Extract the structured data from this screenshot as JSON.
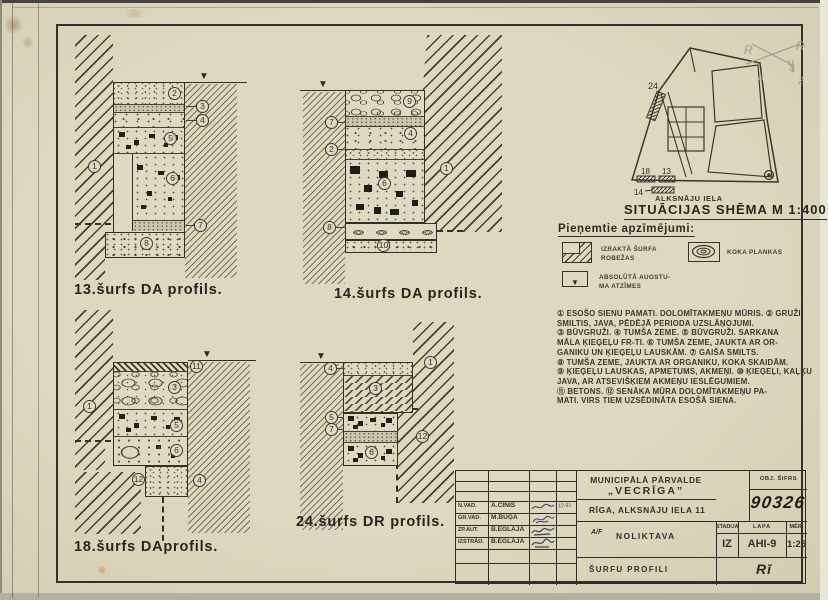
{
  "icons": {
    "level_mark": "▼",
    "legend_triangle": "▼"
  },
  "profiles": [
    {
      "caption": "13.šurfs DA profils.",
      "badges": [
        "1",
        "2",
        "3",
        "4",
        "5",
        "6",
        "7",
        "8"
      ]
    },
    {
      "caption": "14.šurfs DA profils.",
      "badges": [
        "9",
        "7",
        "4",
        "2",
        "6",
        "8",
        "10",
        "1"
      ]
    },
    {
      "caption": "18.šurfs DAprofils.",
      "badges": [
        "1",
        "11",
        "3",
        "5",
        "6",
        "12",
        "4"
      ]
    },
    {
      "caption": "24.šurfs DR profils.",
      "badges": [
        "4",
        "1",
        "3",
        "5",
        "7",
        "12",
        "6"
      ]
    }
  ],
  "situation": {
    "street": "ALKSNĀJU IELA",
    "title": "SITUĀCIJAS SHĒMA M 1:400",
    "markers": [
      "24",
      "18",
      "13",
      "14"
    ],
    "pencil": [
      "R",
      "R",
      "a",
      "2"
    ]
  },
  "legend": {
    "title": "Pieņemtie apzīmējumi:",
    "items": [
      {
        "lines": [
          "IZRAKTĀ ŠURFA",
          "ROBEŽAS"
        ]
      },
      {
        "lines": [
          "KOKA PLANKAS"
        ]
      },
      {
        "lines": [
          "ABSOLŪTĀ AUGSTU-",
          "MA ATZĪMES"
        ]
      }
    ]
  },
  "notes": {
    "lines": [
      "① ESOŠO SIENU PAMATI. DOLOMĪTAKMEŅU MŪRIS. ② GRUŽI,",
      "SMILTIS, JAVA, PĒDĒJĀ PERIODA UZSLĀŅOJUMI.",
      "③ BŪVGRUŽI. ④ TUMŠA ZEME. ⑤ BŪVGRUŽI. SARKANA",
      "MĀLA ĶIEĢEĻU FR-TI. ⑥ TUMŠA ZEME, JAUKTA AR OR-",
      "GANIKU UN ĶIEĢEĻU LAUSKĀM. ⑦ GAIŠA SMILTS.",
      "⑧ TUMŠA ZEME, JAUKTA AR ORGANIKU, KOKA SKAIDĀM.",
      "⑨ ĶIEĢEĻU LAUSKAS, APMETUMS, AKMEŅI. ⑩ ĶIEĢEĻI, KAĻĶU",
      "JAVA, AR ATSEVIŠĶIEM AKMEŅU IESLĒGUMIEM.",
      "⑪ BETONS. ⑫ SENĀKA MŪRA DOLOMĪTAKMEŅU PA-",
      "MATI. VIRS TIEM UZSĒDINĀTA ESOŠĀ SIENA."
    ]
  },
  "titleblock": {
    "org_line1": "MUNICIPĀLĀ PĀRVALDE",
    "org_line2": "„VECRĪGA”",
    "obj_cipher_label": "OBJ. ŠIFRS",
    "obj_number": "90326",
    "address": "RĪGA, ALKSNĀJU IELA 11",
    "object_prefix": "A/F",
    "object_name": "NOLIKTAVA",
    "doc_title": "ŠURFU PROFILI",
    "stage_label": "STADIJA",
    "sheet_label": "LAPA",
    "scale_label": "MĒR.",
    "stage": "IZ",
    "sheet": "AHI-9",
    "scale": "1:25",
    "date": "12.91",
    "sign": "Rī",
    "rows": [
      {
        "role": "N.VAD.",
        "name": "A.CINIS"
      },
      {
        "role": "GR.VAD.",
        "name": "M.BUĢA"
      },
      {
        "role": "ZP.AUT.",
        "name": "B.EGLĀJA"
      },
      {
        "role": "IZSTRĀD.",
        "name": "B.EGLĀJA"
      }
    ]
  }
}
